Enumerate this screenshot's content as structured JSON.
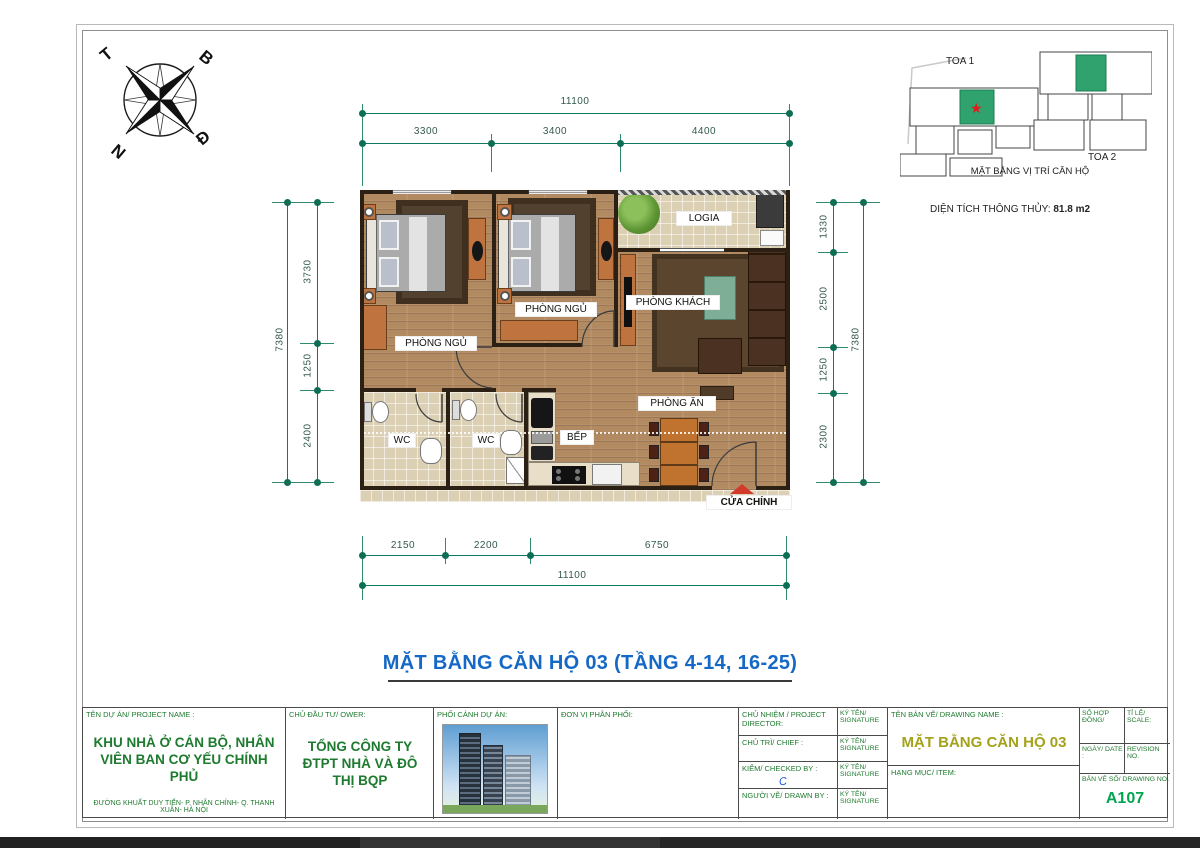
{
  "compass": {
    "north": "B",
    "east": "Đ",
    "south": "N",
    "west": "T"
  },
  "key_plan": {
    "tower1": "TOA 1",
    "tower2": "TOA 2",
    "caption": "MẶT BẰNG VỊ TRÍ CĂN HỘ",
    "area_label": "DIỆN TÍCH THÔNG THỦY:",
    "area_value": "81.8 m2"
  },
  "plan": {
    "rooms": {
      "bedroom1": "PHÒNG NGỦ",
      "bedroom2": "PHÒNG NGỦ",
      "logia": "LOGIA",
      "living": "PHÒNG KHÁCH",
      "dining": "PHÒNG ĂN",
      "kitchen": "BẾP",
      "wc1": "WC",
      "wc2": "WC",
      "main_door": "CỬA CHÍNH"
    },
    "dims": {
      "top": {
        "overall": "11100",
        "s1": "3300",
        "s2": "3400",
        "s3": "4400"
      },
      "bottom": {
        "overall": "11100",
        "s1": "2150",
        "s2": "2200",
        "s3": "6750"
      },
      "left": {
        "overall": "7380",
        "s1": "3730",
        "s2": "1250",
        "s3": "2400"
      },
      "right": {
        "overall": "7380",
        "s1": "1330",
        "s2": "2500",
        "s3": "1250",
        "s4": "2300"
      }
    }
  },
  "title": "MẶT BẰNG CĂN HỘ 03 (TẦNG 4-14, 16-25)",
  "title_block": {
    "project_name_label": "TÊN DỰ ÁN/ PROJECT NAME :",
    "project_name": "KHU NHÀ Ở CÁN BỘ, NHÂN VIÊN BAN CƠ YẾU CHÍNH PHỦ",
    "project_address": "ĐƯỜNG KHUẤT DUY TIẾN- P. NHÂN CHÍNH- Q. THANH XUÂN- HÀ NỘI",
    "owner_label": "CHỦ ĐẦU TƯ/ OWER:",
    "owner_name": "TỔNG CÔNG TY ĐTPT NHÀ VÀ ĐÔ THỊ BQP",
    "perspective_label": "PHỐI CẢNH DỰ ÁN:",
    "distributor_label": "ĐƠN VỊ PHÂN PHỐI:",
    "director_label": "CHỦ NHIỆM / PROJECT DIRECTOR:",
    "chief_label": "CHỦ TRÌ/ CHIEF :",
    "checked_label": "KIỂM/ CHECKED BY :",
    "checked_mark": "C",
    "drawn_label": "NGƯỜI VẼ/ DRAWN BY :",
    "signature_label": "KÝ TÊN/ SIGNATURE",
    "drawing_name_label": "TÊN BẢN VẼ/ DRAWING NAME :",
    "drawing_name": "MẶT BẰNG CĂN HỘ 03",
    "item_label": "HẠNG MỤC/ ITEM:",
    "contract_label": "SỐ HỢP ĐỒNG/",
    "scale_label": "TỈ LỆ/ SCALE:",
    "date_label": "NGÀY/ DATE :",
    "revision_label": "REVISION NO.",
    "drawing_no_label": "BẢN VẼ SỐ/ DRAWING NO.",
    "drawing_no": "A107"
  },
  "colors": {
    "dimension_line": "#0d7a5f",
    "title_blue": "#1668c7",
    "block_green": "#1d7a2e",
    "drawing_name_olive": "#a3a21a",
    "drawing_no_green": "#00a550",
    "furniture_orange": "#bf7440",
    "unit_highlight_green": "#2fa26e",
    "star_red": "#e01b1b"
  }
}
